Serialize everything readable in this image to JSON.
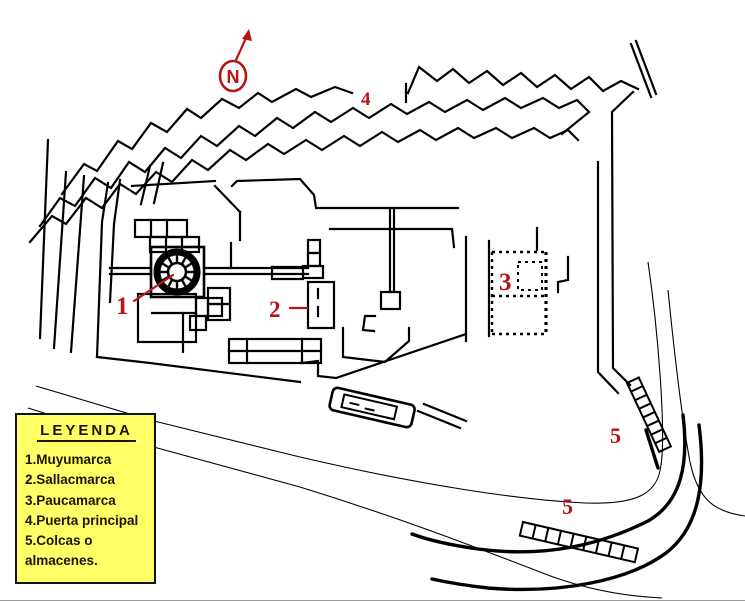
{
  "map": {
    "north_label": "N",
    "markers": [
      {
        "num": "1"
      },
      {
        "num": "2"
      },
      {
        "num": "3"
      },
      {
        "num": "4"
      },
      {
        "num": "5"
      },
      {
        "num": "5"
      }
    ],
    "feature_icons": [
      "round-tower-icon",
      "dotted-compound-icon",
      "colca-ladder-icon",
      "zigzag-wall-icon",
      "north-arrow-icon"
    ]
  },
  "legend": {
    "title": "LEYENDA",
    "items": [
      "1.Muyumarca",
      "2.Sallacmarca",
      "3.Paucamarca",
      "4.Puerta principal",
      "5.Colcas o almacenes."
    ]
  },
  "colors": {
    "accent_red": "#b91414",
    "line": "#000000",
    "background": "#ffffff",
    "legend_bg": "#ffff66",
    "legend_text": "#1c1400",
    "legend_border": "#111111"
  }
}
